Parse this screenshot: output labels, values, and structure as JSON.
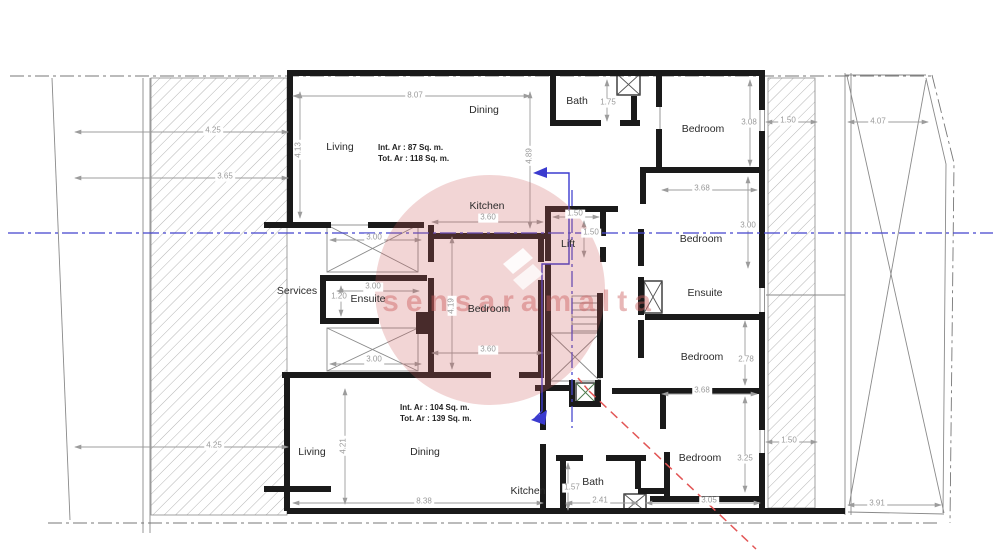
{
  "drawing": {
    "type": "architectural-floor-plan",
    "watermark_text": "sensaramalta"
  },
  "colors": {
    "wall": "#1a1a1a",
    "thin_line": "#8a8a8a",
    "dim_line": "#9c9c9c",
    "dim_text": "#9a9a9a",
    "centerline_blue": "#4646cf",
    "section_red": "#e25555",
    "watermark_pink": "rgba(205,95,95,0.45)"
  },
  "rooms": [
    {
      "id": "dining-top",
      "label": "Dining"
    },
    {
      "id": "bath-top",
      "label": "Bath"
    },
    {
      "id": "bedroom-top-right",
      "label": "Bedroom"
    },
    {
      "id": "living-top",
      "label": "Living"
    },
    {
      "id": "kitchen-top",
      "label": "Kitchen"
    },
    {
      "id": "lift",
      "label": "Lift"
    },
    {
      "id": "bedroom-mid-right",
      "label": "Bedroom"
    },
    {
      "id": "services",
      "label": "Services"
    },
    {
      "id": "ensuite-left",
      "label": "Ensuite"
    },
    {
      "id": "bedroom-center",
      "label": "Bedroom"
    },
    {
      "id": "ensuite-right",
      "label": "Ensuite"
    },
    {
      "id": "bedroom-lower-right",
      "label": "Bedroom"
    },
    {
      "id": "living-bottom",
      "label": "Living"
    },
    {
      "id": "dining-bottom",
      "label": "Dining"
    },
    {
      "id": "kitchen-bottom",
      "label": "Kitchen"
    },
    {
      "id": "bath-bottom",
      "label": "Bath"
    },
    {
      "id": "bedroom-bottom-right",
      "label": "Bedroom"
    }
  ],
  "dims": [
    {
      "text": "8.07"
    },
    {
      "text": "4.13"
    },
    {
      "text": "4.89"
    },
    {
      "text": "1.75"
    },
    {
      "text": "3.08"
    },
    {
      "text": "1.50"
    },
    {
      "text": "4.07"
    },
    {
      "text": "4.25"
    },
    {
      "text": "3.65"
    },
    {
      "text": "3.60"
    },
    {
      "text": "3.00"
    },
    {
      "text": "1.50"
    },
    {
      "text": "1.50"
    },
    {
      "text": "3.00"
    },
    {
      "text": "3.68"
    },
    {
      "text": "3.00"
    },
    {
      "text": "1.20"
    },
    {
      "text": "4.19"
    },
    {
      "text": "3.60"
    },
    {
      "text": "3.00"
    },
    {
      "text": "2.78"
    },
    {
      "text": "3.68"
    },
    {
      "text": "3.25"
    },
    {
      "text": "1.50"
    },
    {
      "text": "4.21"
    },
    {
      "text": "4.25"
    },
    {
      "text": "8.38"
    },
    {
      "text": "1.57"
    },
    {
      "text": "2.41"
    },
    {
      "text": "3.05"
    },
    {
      "text": "3.91"
    }
  ],
  "area_notes": {
    "upper": {
      "line1": "Int. Ar : 87 Sq. m.",
      "line2": "Tot. Ar : 118 Sq. m."
    },
    "lower": {
      "line1": "Int. Ar : 104 Sq. m.",
      "line2": "Tot. Ar : 139 Sq. m."
    }
  }
}
